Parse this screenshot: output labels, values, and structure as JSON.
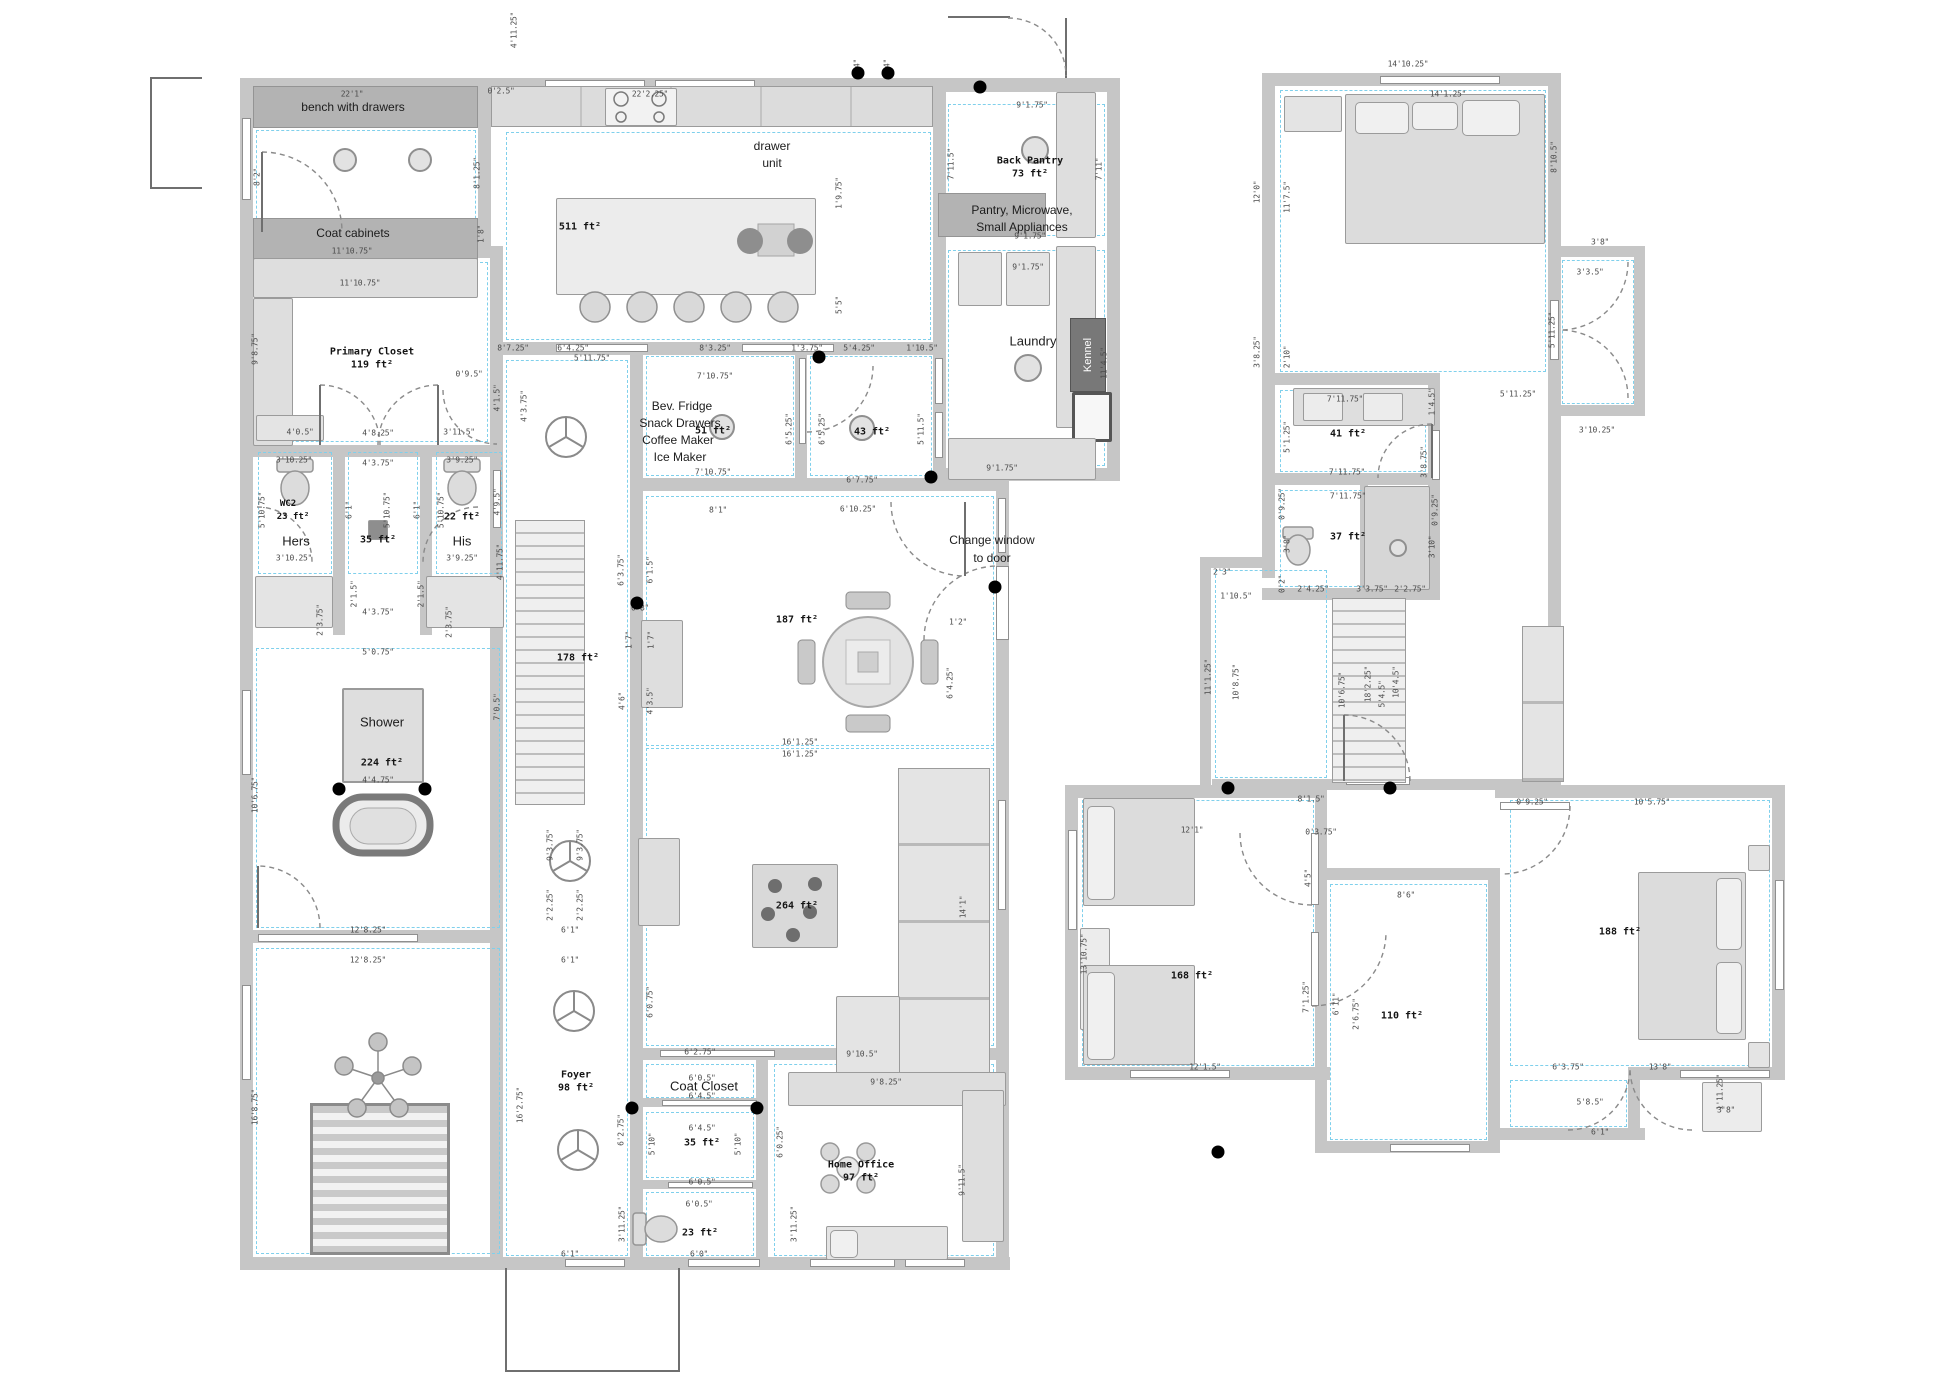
{
  "labels": {
    "bench": "bench with drawers",
    "coat_cabinets": "Coat cabinets",
    "drawer1": "drawer",
    "drawer2": "unit",
    "kitchen_area": "511 ft²",
    "back_pantry": "Back Pantry",
    "back_pantry_area": "73 ft²",
    "pantry1": "Pantry, Microwave,",
    "pantry2": "Small Appliances",
    "laundry": "Laundry",
    "kennel": "Kennel",
    "primary_closet": "Primary Closet",
    "primary_closet_area": "119 ft²",
    "wc2": "WC2",
    "wc2_area": "23 ft²",
    "hers": "Hers",
    "mid_wc_area": "35 ft²",
    "his_area": "22 ft²",
    "his": "His",
    "shower": "Shower",
    "shower_area": "224 ft²",
    "stair_area": "178 ft²",
    "bev1": "Bev. Fridge",
    "bev2": "Snack Drawers",
    "bev3": "Coffee Maker",
    "bev4": "Ice Maker",
    "bev_area": "51 ft²",
    "rm43_area": "43 ft²",
    "note1": "Change window",
    "note2": "to door",
    "dining_area": "187 ft²",
    "ottoman_area": "264 ft²",
    "foyer": "Foyer",
    "foyer_area": "98 ft²",
    "coat_closet": "Coat Closet",
    "closet35_area": "35 ft²",
    "wc23_area": "23 ft²",
    "office": "Home Office",
    "office_area": "97 ft²",
    "bath41_area": "41 ft²",
    "wc37_area": "37 ft²",
    "bed168_area": "168 ft²",
    "rm110_area": "110 ft²",
    "bed188_area": "188 ft²"
  },
  "dots": [
    [
      980,
      87
    ],
    [
      858,
      73
    ],
    [
      888,
      73
    ],
    [
      819,
      357
    ],
    [
      931,
      477
    ],
    [
      637,
      603
    ],
    [
      995,
      587
    ],
    [
      339,
      789
    ],
    [
      425,
      789
    ],
    [
      632,
      1108
    ],
    [
      757,
      1108
    ],
    [
      1228,
      788
    ],
    [
      1390,
      788
    ],
    [
      1218,
      1152
    ]
  ],
  "dim_labels": [
    [
      "4'11.25\"",
      514,
      30,
      1
    ],
    [
      "0'2.5\"",
      501,
      91,
      0
    ],
    [
      "22'1\"",
      352,
      94,
      0
    ],
    [
      "8'2\"",
      257,
      177,
      1
    ],
    [
      "8'1.25\"",
      477,
      173,
      1
    ],
    [
      "22'2.25\"",
      650,
      94,
      0
    ],
    [
      "0'4\"",
      857,
      68,
      1
    ],
    [
      "0'4\"",
      887,
      68,
      1
    ],
    [
      "11'10.75\"",
      352,
      251,
      0
    ],
    [
      "1'8\"",
      481,
      234,
      1
    ],
    [
      "11'10.75\"",
      360,
      283,
      0
    ],
    [
      "9'1.75\"",
      1032,
      105,
      0
    ],
    [
      "7'11.5\"",
      951,
      164,
      1
    ],
    [
      "7'11\"",
      1099,
      169,
      1
    ],
    [
      "9'1.75\"",
      1030,
      236,
      0
    ],
    [
      "9'1.75\"",
      1028,
      267,
      0
    ],
    [
      "1'9.75\"",
      839,
      193,
      1
    ],
    [
      "5'5\"",
      839,
      305,
      1
    ],
    [
      "11'4.5\"",
      1104,
      363,
      1
    ],
    [
      "9'1.75\"",
      1002,
      468,
      0
    ],
    [
      "9'8.75\"",
      255,
      349,
      1
    ],
    [
      "8'7.25\"",
      513,
      348,
      0
    ],
    [
      "6'4.25\"",
      573,
      348,
      0
    ],
    [
      "8'3.25\"",
      715,
      348,
      0
    ],
    [
      "1'3.75\"",
      807,
      348,
      0
    ],
    [
      "5'4.25\"",
      859,
      348,
      0
    ],
    [
      "1'10.5\"",
      922,
      348,
      0
    ],
    [
      "5'11.75\"",
      592,
      358,
      0
    ],
    [
      "7'10.75\"",
      715,
      376,
      0
    ],
    [
      "7'10.75\"",
      713,
      472,
      0
    ],
    [
      "6'5.25\"",
      789,
      429,
      1
    ],
    [
      "6'5.25\"",
      822,
      429,
      1
    ],
    [
      "5'11.5\"",
      921,
      429,
      1
    ],
    [
      "6'7.75\"",
      862,
      480,
      0
    ],
    [
      "8'1\"",
      718,
      510,
      0
    ],
    [
      "6'10.25\"",
      858,
      509,
      0
    ],
    [
      "0'9.5\"",
      469,
      374,
      0
    ],
    [
      "4'1.5\"",
      497,
      398,
      1
    ],
    [
      "3'11.5\"",
      459,
      432,
      0
    ],
    [
      "4'3.75\"",
      524,
      406,
      1
    ],
    [
      "4'0.5\"",
      300,
      432,
      0
    ],
    [
      "4'8.25\"",
      378,
      433,
      0
    ],
    [
      "3'10.25\"",
      294,
      460,
      0
    ],
    [
      "4'3.75\"",
      378,
      463,
      0
    ],
    [
      "3'9.25\"",
      462,
      460,
      0
    ],
    [
      "5'10.75\"",
      262,
      510,
      1
    ],
    [
      "6'1\"",
      349,
      510,
      1
    ],
    [
      "5'10.75\"",
      387,
      510,
      1
    ],
    [
      "6'1\"",
      417,
      510,
      1
    ],
    [
      "5'10.75\"",
      441,
      510,
      1
    ],
    [
      "4'9.5\"",
      497,
      502,
      1
    ],
    [
      "3'10.25\"",
      294,
      558,
      0
    ],
    [
      "3'9.25\"",
      462,
      558,
      0
    ],
    [
      "2'1.5\"",
      354,
      594,
      1
    ],
    [
      "2'1.5\"",
      421,
      594,
      1
    ],
    [
      "2'3.75\"",
      320,
      620,
      1
    ],
    [
      "2'3.75\"",
      449,
      622,
      1
    ],
    [
      "4'3.75\"",
      378,
      612,
      0
    ],
    [
      "5'0.75\"",
      378,
      652,
      0
    ],
    [
      "4'11.75\"",
      500,
      562,
      1
    ],
    [
      "6'3.75\"",
      621,
      570,
      1
    ],
    [
      "6'1.5\"",
      650,
      570,
      1
    ],
    [
      "0'8\"",
      640,
      608,
      0
    ],
    [
      "1'7\"",
      629,
      640,
      1
    ],
    [
      "1'7\"",
      651,
      640,
      1
    ],
    [
      "4'6\"",
      622,
      701,
      1
    ],
    [
      "4'3.5\"",
      650,
      701,
      1
    ],
    [
      "7'0.5\"",
      497,
      707,
      1
    ],
    [
      "10'6.75\"",
      255,
      795,
      1
    ],
    [
      "4'4.75\"",
      378,
      780,
      0
    ],
    [
      "12'8.25\"",
      368,
      930,
      0
    ],
    [
      "12'8.25\"",
      368,
      960,
      0
    ],
    [
      "6'1\"",
      570,
      930,
      0
    ],
    [
      "6'1\"",
      570,
      960,
      0
    ],
    [
      "2'2.25\"",
      550,
      905,
      1
    ],
    [
      "2'2.25\"",
      580,
      905,
      1
    ],
    [
      "9'3.75\"",
      550,
      845,
      1
    ],
    [
      "9'3.75\"",
      580,
      845,
      1
    ],
    [
      "16'8.75\"",
      255,
      1107,
      1
    ],
    [
      "16'2.75\"",
      520,
      1105,
      1
    ],
    [
      "1'2\"",
      958,
      622,
      0
    ],
    [
      "6'4.25\"",
      950,
      683,
      1
    ],
    [
      "16'1.25\"",
      800,
      742,
      0
    ],
    [
      "16'1.25\"",
      800,
      754,
      0
    ],
    [
      "14'1\"",
      963,
      907,
      1
    ],
    [
      "9'10.5\"",
      862,
      1054,
      0
    ],
    [
      "6'2.75\"",
      700,
      1052,
      0
    ],
    [
      "6'2.75\"",
      621,
      1130,
      1
    ],
    [
      "6'0.75\"",
      650,
      1002,
      1
    ],
    [
      "6'0.5\"",
      702,
      1078,
      0
    ],
    [
      "6'4.5\"",
      702,
      1096,
      0
    ],
    [
      "6'4.5\"",
      702,
      1128,
      0
    ],
    [
      "5'10\"",
      652,
      1144,
      1
    ],
    [
      "5'10\"",
      738,
      1144,
      1
    ],
    [
      "6'0.25\"",
      780,
      1142,
      1
    ],
    [
      "6'0.5\"",
      702,
      1182,
      0
    ],
    [
      "9'8.25\"",
      886,
      1082,
      0
    ],
    [
      "9'11.5\"",
      962,
      1180,
      1
    ],
    [
      "3'11.25\"",
      622,
      1224,
      1
    ],
    [
      "3'11.25\"",
      794,
      1224,
      1
    ],
    [
      "6'0.5\"",
      699,
      1204,
      0
    ],
    [
      "6'0\"",
      699,
      1254,
      0
    ],
    [
      "6'1\"",
      570,
      1254,
      0
    ],
    [
      "14'10.25\"",
      1408,
      64,
      0
    ],
    [
      "14'1.25\"",
      1448,
      94,
      0
    ],
    [
      "12'0\"",
      1257,
      192,
      1
    ],
    [
      "11'7.5\"",
      1287,
      197,
      1
    ],
    [
      "8'10.5\"",
      1554,
      157,
      1
    ],
    [
      "3'8\"",
      1600,
      242,
      0
    ],
    [
      "3'3.5\"",
      1590,
      272,
      0
    ],
    [
      "5'11.25\"",
      1552,
      330,
      1
    ],
    [
      "5'11.25\"",
      1518,
      394,
      0
    ],
    [
      "3'10.25\"",
      1597,
      430,
      0
    ],
    [
      "3'8.25\"",
      1257,
      352,
      1
    ],
    [
      "2'10\"",
      1287,
      357,
      1
    ],
    [
      "7'11.75\"",
      1345,
      399,
      0
    ],
    [
      "1'4.5\"",
      1432,
      402,
      1
    ],
    [
      "5'1.25\"",
      1287,
      437,
      1
    ],
    [
      "3'8.75\"",
      1424,
      462,
      1
    ],
    [
      "7'11.75\"",
      1347,
      472,
      0
    ],
    [
      "0'9.25\"",
      1282,
      504,
      1
    ],
    [
      "7'11.75\"",
      1348,
      496,
      0
    ],
    [
      "3'8\"",
      1287,
      544,
      1
    ],
    [
      "0'2\"",
      1282,
      584,
      1
    ],
    [
      "2'4.25\"",
      1313,
      589,
      0
    ],
    [
      "3'3.75\"",
      1372,
      589,
      0
    ],
    [
      "2'2.75\"",
      1410,
      589,
      0
    ],
    [
      "3'10\"",
      1432,
      547,
      1
    ],
    [
      "0'9.25\"",
      1435,
      510,
      1
    ],
    [
      "2'3\"",
      1222,
      572,
      0
    ],
    [
      "1'10.5\"",
      1236,
      596,
      0
    ],
    [
      "11'1.25\"",
      1208,
      677,
      1
    ],
    [
      "10'8.75\"",
      1236,
      682,
      1
    ],
    [
      "10'6.75\"",
      1342,
      690,
      1
    ],
    [
      "18'2.25\"",
      1368,
      684,
      1
    ],
    [
      "5'4.5\"",
      1382,
      694,
      1
    ],
    [
      "10'4.5\"",
      1396,
      682,
      1
    ],
    [
      "8'1.5\"",
      1311,
      799,
      0
    ],
    [
      "12'1\"",
      1192,
      830,
      0
    ],
    [
      "0'3.75\"",
      1321,
      832,
      0
    ],
    [
      "4'5\"",
      1308,
      878,
      1
    ],
    [
      "8'6\"",
      1406,
      895,
      0
    ],
    [
      "13'10.75\"",
      1084,
      954,
      1
    ],
    [
      "7'1.25\"",
      1306,
      997,
      1
    ],
    [
      "6'11\"",
      1336,
      1004,
      1
    ],
    [
      "2'6.75\"",
      1356,
      1014,
      1
    ],
    [
      "12'1.5\"",
      1205,
      1067,
      0
    ],
    [
      "0'9.25\"",
      1532,
      802,
      0
    ],
    [
      "10'5.75\"",
      1652,
      802,
      0
    ],
    [
      "13'8\"",
      1660,
      1067,
      0
    ],
    [
      "6'3.75\"",
      1568,
      1067,
      0
    ],
    [
      "5'8.5\"",
      1590,
      1102,
      0
    ],
    [
      "6'1\"",
      1600,
      1132,
      0
    ],
    [
      "1'11.25\"",
      1720,
      1092,
      1
    ],
    [
      "3'8\"",
      1726,
      1110,
      0
    ]
  ]
}
